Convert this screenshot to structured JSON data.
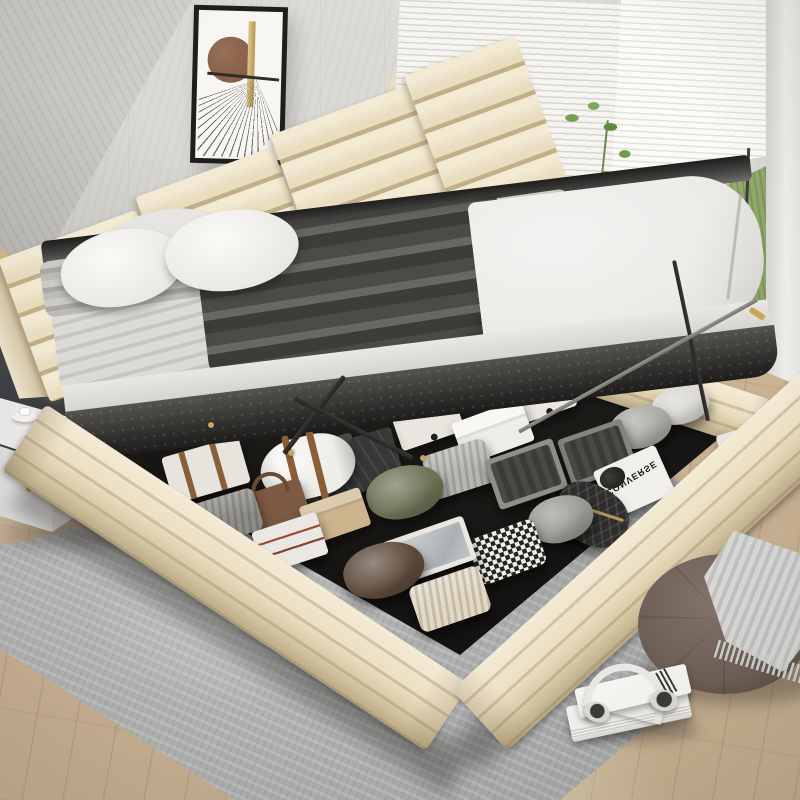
{
  "scene": {
    "description": "Beige upholstered queen platform bed with hydraulic lift-up mattress revealing organized under-bed storage, in a modern bedroom with window, rug, pouf and nightstand",
    "colors": {
      "wall": "#d9d8d5",
      "accentwall": "#35373a",
      "bed": "#ecdfc2",
      "bedshade": "#baa985",
      "interior": "#171513",
      "mattress": "#eae9e6",
      "throwdark": "#4c4b48",
      "rug": "#b2b4b3",
      "wood": "#cbb295",
      "grass": "#b0c287",
      "pouf": "#6e5f56",
      "gold": "#c9a557"
    },
    "objects": [
      "framed-abstract-art",
      "led-accent-panel",
      "venetian-blinds",
      "lawn-view",
      "hanging-plant",
      "channel-tufted-headboard",
      "lifted-mattress",
      "gas-lift-struts",
      "storage-compartment",
      "area-rug",
      "wood-floor",
      "nightstand",
      "round-pouf",
      "knit-throw",
      "book-stack",
      "headphones"
    ]
  },
  "storage_items": [
    {
      "name": "white-corner-box-small",
      "type": "cornerbox",
      "x": 552,
      "y": 356,
      "w": 50,
      "h": 34,
      "rot": -19,
      "bg": "#e6e3dc"
    },
    {
      "name": "white-corner-box-2",
      "type": "cornerbox",
      "x": 513,
      "y": 376,
      "w": 60,
      "h": 40,
      "rot": -19,
      "bg": "#eae7e0"
    },
    {
      "name": "white-pillow-back",
      "type": "pillow",
      "x": 652,
      "y": 386,
      "w": 58,
      "h": 38,
      "rot": -14,
      "bg": "#d9d7d2"
    },
    {
      "name": "white-corner-box-1",
      "type": "cornerbox",
      "x": 394,
      "y": 398,
      "w": 66,
      "h": 44,
      "rot": -19,
      "bg": "#e9e6df"
    },
    {
      "name": "gray-pillow-right",
      "type": "pillow",
      "x": 610,
      "y": 406,
      "w": 62,
      "h": 42,
      "rot": -15,
      "bg": "#a9a8a3"
    },
    {
      "name": "folded-shirt-box",
      "type": "lidbox",
      "x": 456,
      "y": 410,
      "w": 74,
      "h": 44,
      "rot": -20,
      "bg": "#efede7"
    },
    {
      "name": "striped-box-right",
      "type": "stripebox",
      "x": 720,
      "y": 426,
      "w": 64,
      "h": 42,
      "rot": -17,
      "bg": "#e9e7e2"
    },
    {
      "name": "gray-bin-2",
      "type": "bin",
      "x": 563,
      "y": 428,
      "w": 68,
      "h": 50,
      "rot": -19,
      "bg": "#85847f"
    },
    {
      "name": "suitcase",
      "type": "suitcase",
      "x": 298,
      "y": 440,
      "w": 102,
      "h": 55,
      "rot": -17,
      "bg": "#3a3836"
    },
    {
      "name": "storage-trunk-straps",
      "type": "trunk",
      "x": 166,
      "y": 446,
      "w": 80,
      "h": 48,
      "rot": -16,
      "bg": "#e7e4dd"
    },
    {
      "name": "duffel-bag",
      "type": "duffel",
      "x": 260,
      "y": 436,
      "w": 96,
      "h": 62,
      "rot": -14,
      "bg": "#efede8"
    },
    {
      "name": "sweater-stack",
      "type": "knit",
      "x": 426,
      "y": 446,
      "w": 66,
      "h": 46,
      "rot": -18,
      "bg": "#b9b7b2"
    },
    {
      "name": "gray-bin-1",
      "type": "bin",
      "x": 490,
      "y": 448,
      "w": 72,
      "h": 52,
      "rot": -19,
      "bg": "#8f8e8a"
    },
    {
      "name": "converse-tote",
      "type": "converse",
      "x": 600,
      "y": 456,
      "w": 68,
      "h": 52,
      "rot": -24,
      "bg": "#f0efec",
      "label": "CONVERSE"
    },
    {
      "name": "olive-pillow",
      "type": "pillow",
      "x": 366,
      "y": 466,
      "w": 78,
      "h": 52,
      "rot": -16,
      "bg": "#6d7054"
    },
    {
      "name": "leather-bag",
      "type": "bag",
      "x": 245,
      "y": 486,
      "w": 62,
      "h": 44,
      "rot": -18,
      "bg": "#7d5a42"
    },
    {
      "name": "quilted-shoe-bag",
      "type": "quilt",
      "x": 554,
      "y": 486,
      "w": 76,
      "h": 58,
      "rot": 28,
      "bg": "#2f2e2c"
    },
    {
      "name": "kraft-box",
      "type": "box",
      "x": 303,
      "y": 496,
      "w": 64,
      "h": 40,
      "rot": -19,
      "bg": "#cdb48d"
    },
    {
      "name": "gray-pillow-center",
      "type": "pillow",
      "x": 528,
      "y": 496,
      "w": 66,
      "h": 46,
      "rot": -18,
      "bg": "#9a9994"
    },
    {
      "name": "folded-gray-blanket",
      "type": "knit",
      "x": 188,
      "y": 496,
      "w": 72,
      "h": 44,
      "rot": -17,
      "bg": "#8e8d88"
    },
    {
      "name": "striped-drawer-box",
      "type": "stripebox",
      "x": 256,
      "y": 521,
      "w": 68,
      "h": 44,
      "rot": -18,
      "bg": "#eae8e3"
    },
    {
      "name": "houndstooth-throw",
      "type": "hound",
      "x": 472,
      "y": 528,
      "w": 70,
      "h": 48,
      "rot": -20,
      "bg": "#e8e6e1"
    },
    {
      "name": "silver-tray-basket",
      "type": "tray",
      "x": 386,
      "y": 528,
      "w": 86,
      "h": 46,
      "rot": -19,
      "bg": "#efeee9"
    },
    {
      "name": "brown-pillow",
      "type": "pillow",
      "x": 343,
      "y": 543,
      "w": 82,
      "h": 54,
      "rot": -17,
      "bg": "#5e4a3b"
    },
    {
      "name": "cream-knit-blanket",
      "type": "knit",
      "x": 413,
      "y": 575,
      "w": 74,
      "h": 48,
      "rot": -19,
      "bg": "#e3d9c4"
    }
  ]
}
